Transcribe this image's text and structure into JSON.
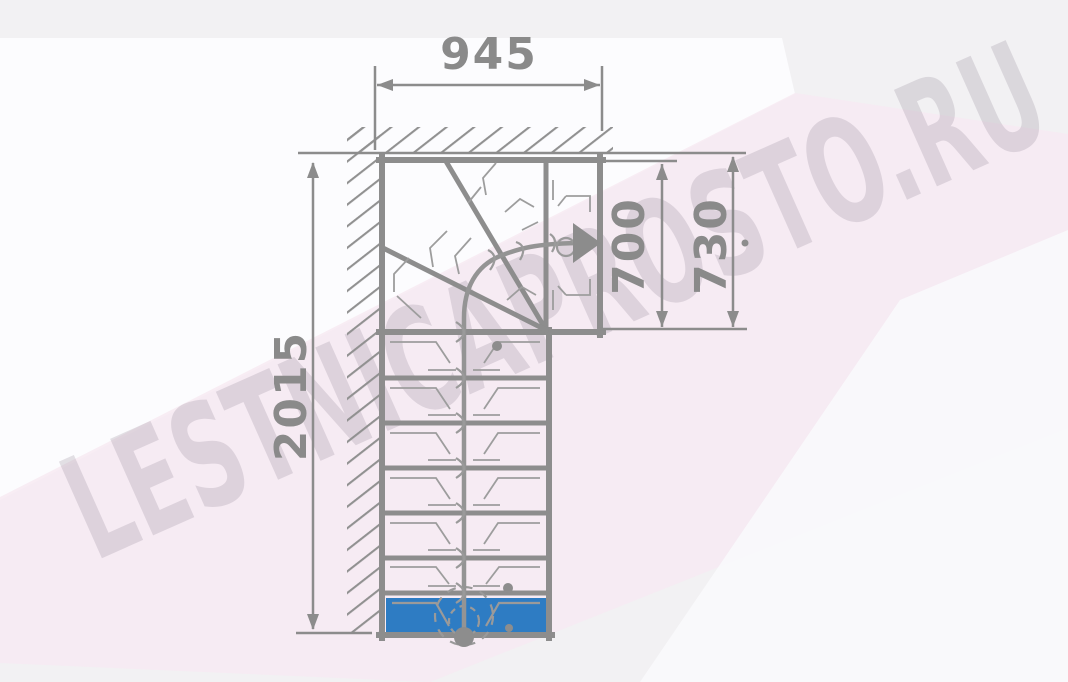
{
  "watermark": {
    "text": "LESTNICAPROSTO.RU"
  },
  "diagram": {
    "type": "L-shaped staircase floor plan, top view",
    "dimensions": {
      "top_width": "945",
      "total_length": "2015",
      "exit_inner_width": "700",
      "exit_outer_width": "730"
    },
    "features": {
      "straight_treads": 6,
      "winder_treads": 3,
      "first_step_highlighted": true,
      "walk_direction": "up and turning right to exit",
      "hatched_walls": [
        "top",
        "left"
      ]
    },
    "colors": {
      "wall_line": "#8d8d8d",
      "thin_line": "#9d9d9d",
      "dimension_text": "#8a8a8a",
      "step_highlight": "#2e7cc3",
      "background": "#f2f1f3",
      "pink_tint": "#f7eaf2",
      "watermark_tint": "#ded6de"
    }
  }
}
